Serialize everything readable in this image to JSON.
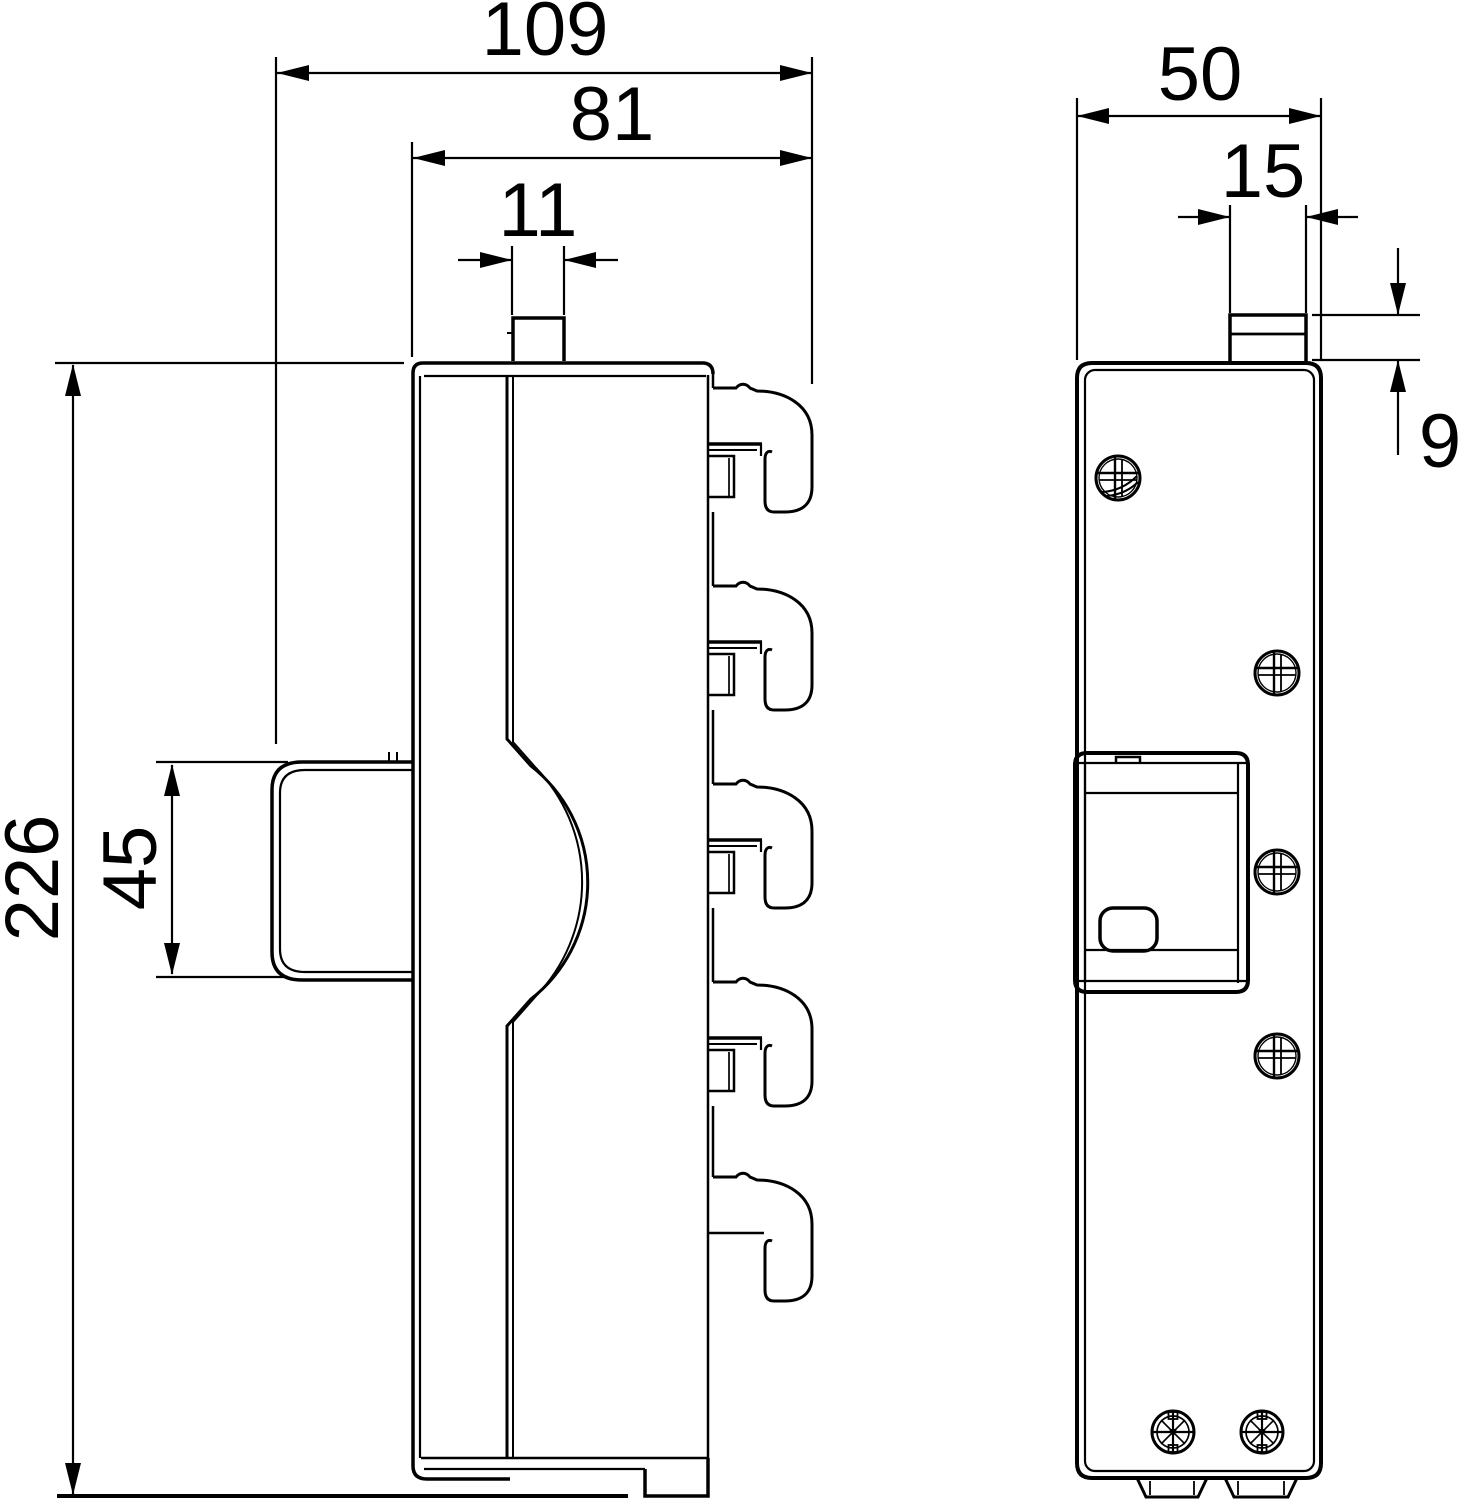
{
  "drawing": {
    "title": "technical dimension drawing, two orthographic views of a DIN-rail mounted device",
    "background_color": "#ffffff",
    "line_color": "#000000",
    "views": {
      "side_view": "side profile with faceplate, handle clip and five rail hooks",
      "front_view": "front face with screws, latch box and mounting feet"
    },
    "dimensions": {
      "overall_width": "109",
      "body_width": "81",
      "top_tab_width_side": "11",
      "overall_height": "226",
      "handle_height": "45",
      "front_width": "50",
      "top_tab_width_front": "15",
      "top_tab_height": "9"
    }
  }
}
